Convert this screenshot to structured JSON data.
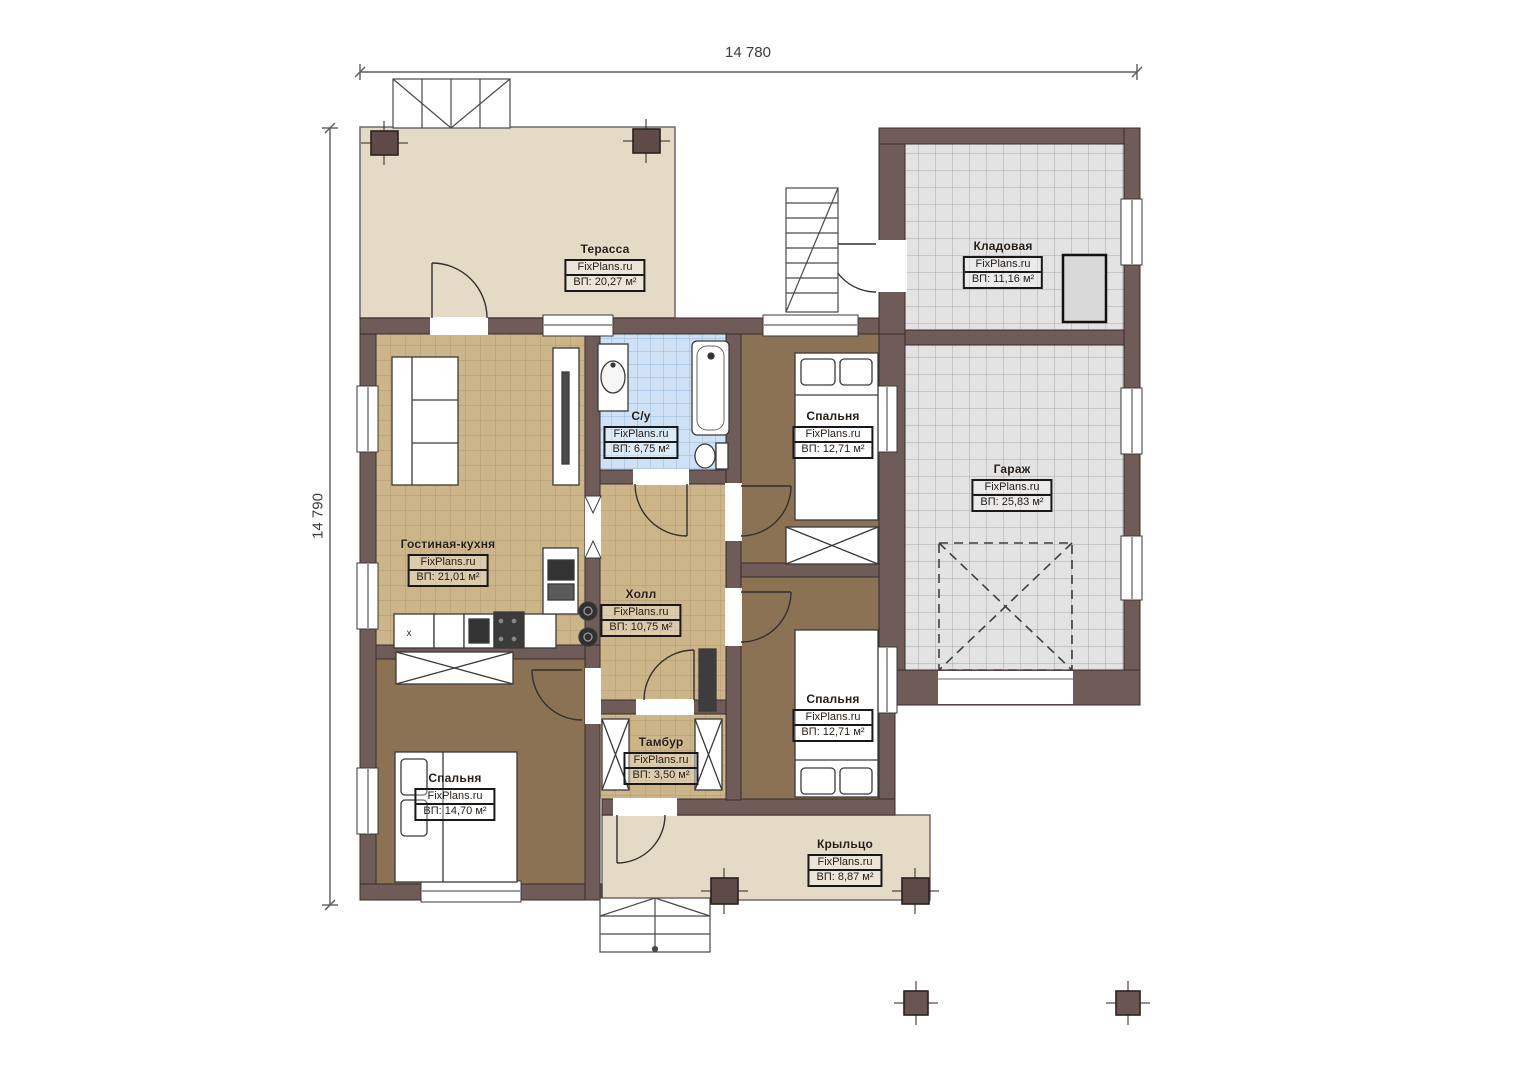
{
  "watermark": "FixPlans.ru",
  "dimensions": {
    "width": "14 780",
    "height": "14 790"
  },
  "rooms": {
    "terrace": {
      "name": "Терасса",
      "area": "ВП: 20,27 м²"
    },
    "storage": {
      "name": "Кладовая",
      "area": "ВП: 11,16 м²"
    },
    "bathroom": {
      "name": "С/у",
      "area": "ВП: 6,75 м²"
    },
    "bedroom1": {
      "name": "Спальня",
      "area": "ВП: 12,71 м²"
    },
    "garage": {
      "name": "Гараж",
      "area": "ВП: 25,83 м²"
    },
    "living": {
      "name": "Гостиная-кухня",
      "area": "ВП: 21,01 м²"
    },
    "hall": {
      "name": "Холл",
      "area": "ВП: 10,75 м²"
    },
    "bedroom2": {
      "name": "Спальня",
      "area": "ВП: 12,71 м²"
    },
    "vestibule": {
      "name": "Тамбур",
      "area": "ВП: 3,50 м²"
    },
    "bedroom3": {
      "name": "Спальня",
      "area": "ВП: 14,70 м²"
    },
    "porch": {
      "name": "Крыльцо",
      "area": "ВП: 8,87 м²"
    }
  },
  "washer_label": "x",
  "colors": {
    "wall": "#6f5b58",
    "terrace_fill": "#e5dac6",
    "tile_tan": "#cdb58a",
    "tile_blue": "#cfe2f5",
    "tile_gray": "#e3e3e3",
    "bedroom_floor": "#8b7254"
  }
}
